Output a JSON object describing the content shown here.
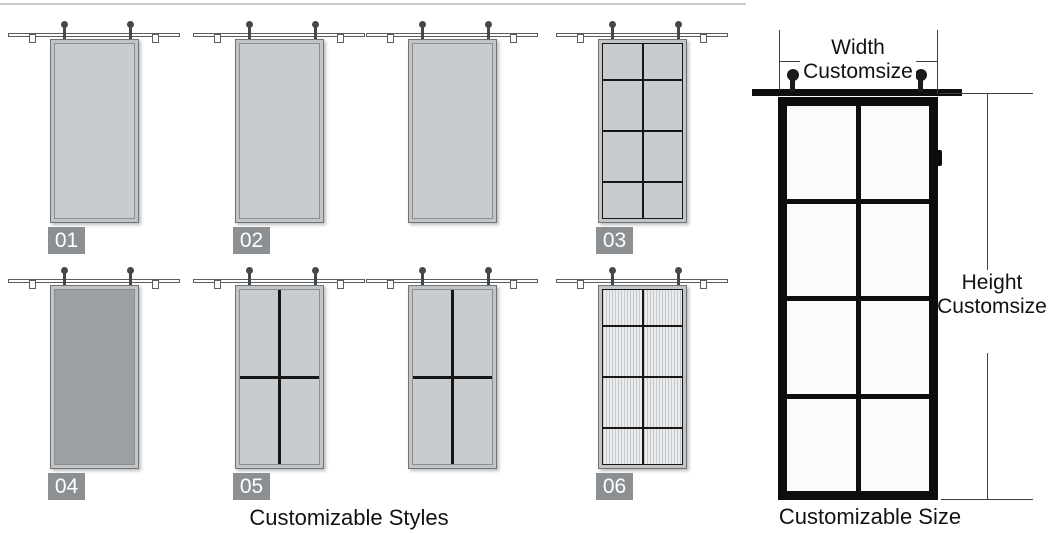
{
  "title": "Sliding barn door customization infographic",
  "styles_section": {
    "caption": "Customizable Styles",
    "doors": [
      {
        "badge": "01",
        "pattern": "flat solid panel, light gray"
      },
      {
        "badge": "02",
        "pattern": "flat solid panel, light gray"
      },
      {
        "badge": "",
        "pattern": "flat solid panel, light gray (unlabeled)"
      },
      {
        "badge": "03",
        "pattern": "8-lite grid, 2 columns x 4 rows"
      },
      {
        "badge": "04",
        "pattern": "flat solid panel, dark gray"
      },
      {
        "badge": "05",
        "pattern": "4-lite cross, 2 columns x 2 rows"
      },
      {
        "badge": "",
        "pattern": "4-lite cross, 2 columns x 2 rows (unlabeled)"
      },
      {
        "badge": "06",
        "pattern": "8-lite grid with fluted glass, 2 columns x 4 rows"
      }
    ]
  },
  "size_section": {
    "caption": "Customizable Size",
    "width_label": {
      "line1": "Width",
      "line2": "Customsize"
    },
    "height_label": {
      "line1": "Height",
      "line2": "Customsize"
    },
    "demo_door_grid": "2 columns x 4 rows"
  },
  "colors": {
    "door_fill_light": "#c9ccce",
    "door_fill_dark": "#9aa0a4",
    "badge_background": "#8c9093",
    "badge_text": "#ffffff",
    "big_door_frame": "#0d0d0d",
    "glass_pane": "#fbfbf9",
    "mullion": "#161616",
    "dimension_line": "#3f3f3f"
  }
}
